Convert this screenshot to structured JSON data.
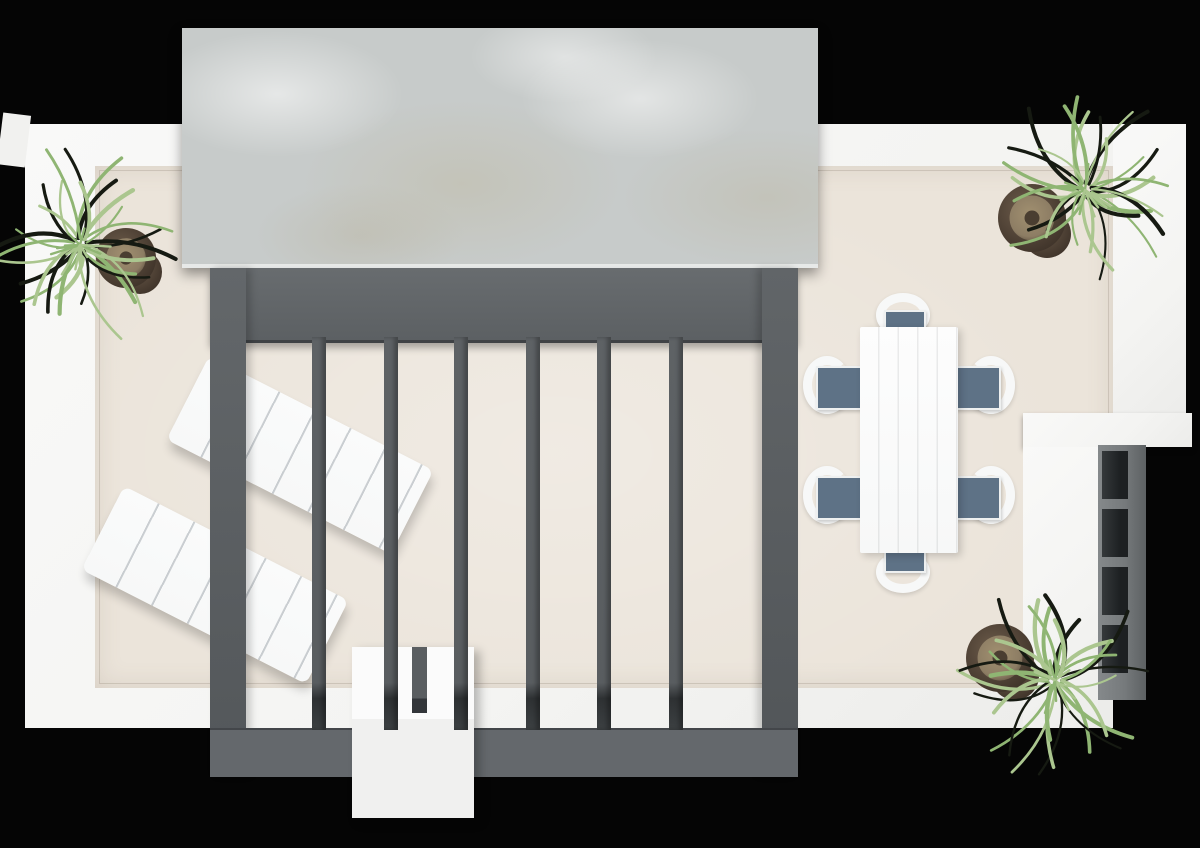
{
  "scene": {
    "description": "Top-down 3D rendered floor plan of a rooftop terrace",
    "background": "#050505",
    "colors": {
      "bg": "#050505",
      "wall": "#f4f4f2",
      "floor": "#ebe4da",
      "marble": "#c7cbca",
      "pergola": "#5c6063",
      "pergola-dark": "#3c4042",
      "white": "#f7f8f8",
      "cushion": "#5e7286",
      "pot-dark": "#43372c",
      "pot-inner": "#8d7d64",
      "leaf-green": "#8fb573",
      "leaf-light": "#abc68f",
      "leaf-dark": "#161a12",
      "shelf": "#767a7c",
      "niche": "#1d2022"
    },
    "objects": {
      "canopy": {
        "label": "marble canopy slab"
      },
      "pergola": {
        "label": "slatted pergola",
        "slat_count": 6
      },
      "loungers": {
        "label": "sun loungers",
        "count": 2
      },
      "dining": {
        "label": "dining set",
        "chair_count": 6
      },
      "plants": {
        "label": "potted plants",
        "count": 3
      },
      "shelf": {
        "label": "wall shelf unit",
        "niche_count": 4
      },
      "bench": {
        "label": "bench"
      }
    }
  }
}
